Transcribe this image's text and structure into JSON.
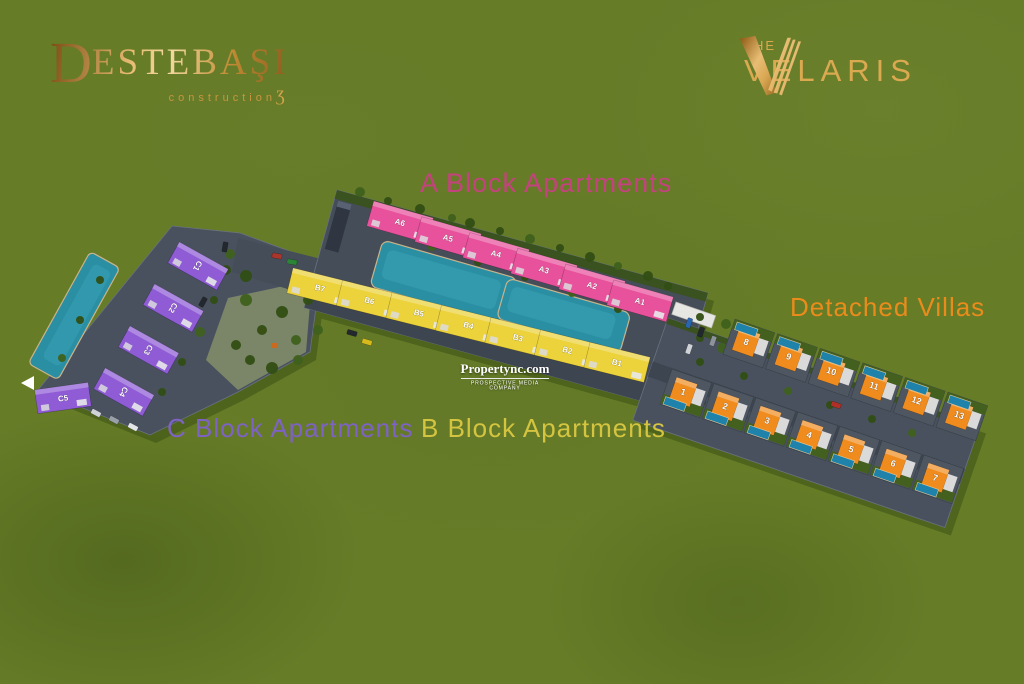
{
  "branding": {
    "developer": {
      "initial": "D",
      "rest": "ESTEBAŞI",
      "sub": "construction",
      "swoosh": "Ʒ"
    },
    "project": {
      "the": "THE",
      "name": "VELARIS"
    }
  },
  "watermark": {
    "title": "Propertync.com",
    "subtitle": "PROSPECTIVE MEDIA COMPANY"
  },
  "labels": {
    "block_a": "A Block Apartments",
    "block_b": "B Block Apartments",
    "block_c": "C Block Apartments",
    "villas": "Detached Villas"
  },
  "colors": {
    "background_green": "#667c27",
    "block_a_roof": "#e8519b",
    "block_b_roof": "#ecd23b",
    "block_c_roof": "#8f5cd6",
    "villa_roof": "#f08c1e",
    "pool": "#2b8fa4",
    "villa_pool": "#1e82ab",
    "road": "#454d59",
    "label_a": "#c4437e",
    "label_b": "#d4c440",
    "label_c": "#7e62c4",
    "label_villas": "#ea8c1c",
    "logo_gold": "#dba950"
  },
  "blocks": {
    "a": {
      "units": [
        "A6",
        "A5",
        "A4",
        "A3",
        "A2",
        "A1"
      ]
    },
    "b": {
      "units": [
        "B7",
        "B6",
        "B5",
        "B4",
        "B3",
        "B2",
        "B1"
      ]
    },
    "c": {
      "units": [
        "C1",
        "C2",
        "C3",
        "C4",
        "C5"
      ]
    },
    "villas": {
      "top_row": [
        "8",
        "9",
        "10",
        "11",
        "12",
        "13"
      ],
      "bottom_row": [
        "1",
        "2",
        "3",
        "4",
        "5",
        "6",
        "7"
      ]
    }
  }
}
